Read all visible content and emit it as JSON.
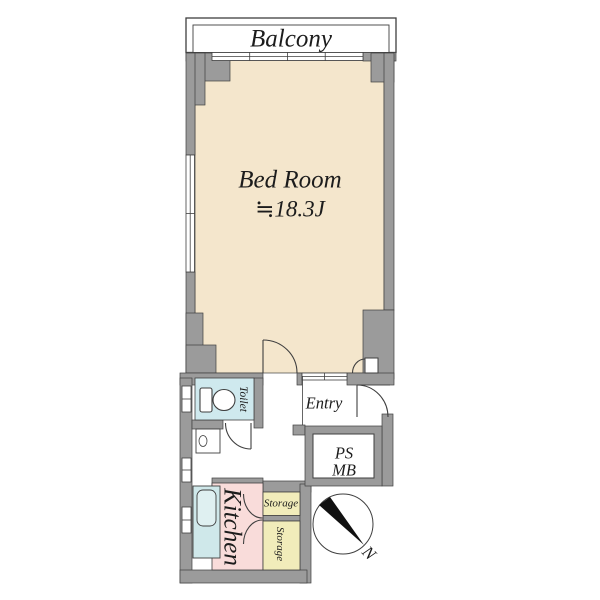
{
  "plan": {
    "balcony": {
      "label": "Balcony"
    },
    "bedroom": {
      "name": "Bed Room",
      "size": "≒18.3J"
    },
    "toilet": {
      "label": "Toilet"
    },
    "entry": {
      "label": "Entry"
    },
    "shaft": {
      "line1": "PS",
      "line2": "MB"
    },
    "kitchen": {
      "label": "Kitchen"
    },
    "storage_upper": {
      "label": "Storage"
    },
    "storage_lower": {
      "label": "Storage"
    },
    "compass": {
      "north_label": "N"
    }
  },
  "colors": {
    "wall": "#9b9b9b",
    "outline": "#3f3f3f",
    "bedroom_floor": "#f4e6cc",
    "toilet_floor": "#cfe9ee",
    "kitchen_floor": "#f9dcda",
    "storage_floor": "#f1ecba",
    "counter": "#cfe8ea",
    "needle": "#111111"
  }
}
